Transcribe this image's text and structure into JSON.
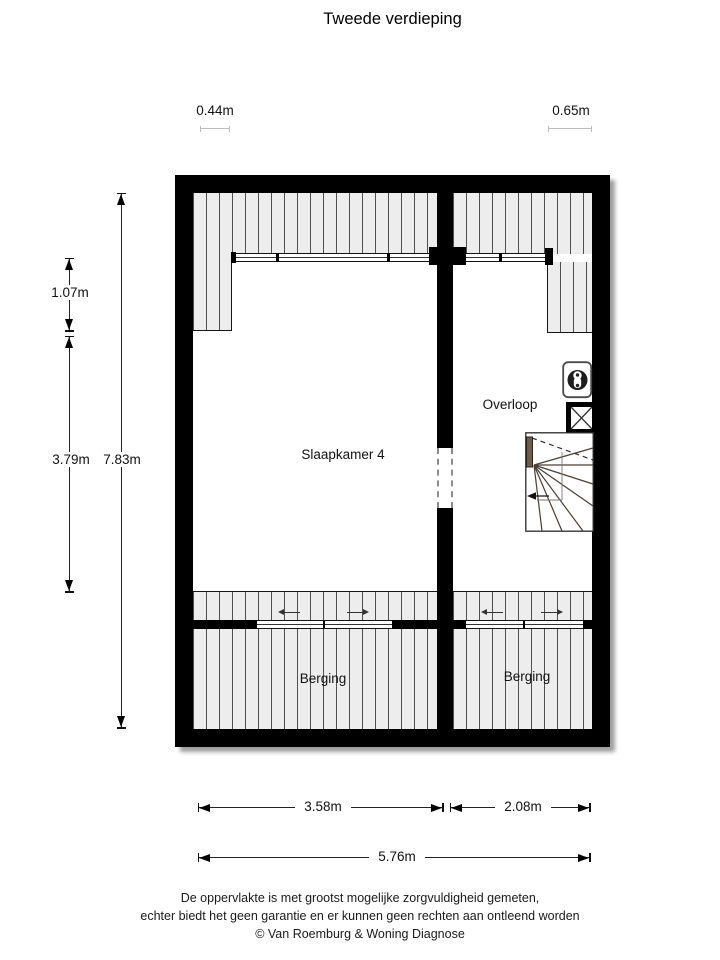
{
  "title": "Tweede verdieping",
  "dimensions": {
    "top_left": "0.44m",
    "top_right": "0.65m",
    "left_upper": "1.07m",
    "left_mid": "3.79m",
    "left_total": "7.83m",
    "bottom_left": "3.58m",
    "bottom_right": "2.08m",
    "bottom_total": "5.76m"
  },
  "rooms": {
    "bedroom": "Slaapkamer 4",
    "landing": "Overloop",
    "storage_left": "Berging",
    "storage_right": "Berging"
  },
  "footer": {
    "lines": [
      "De oppervlakte is met grootst mogelijke zorgvuldigheid gemeten,",
      "echter biedt het geen garantie en er kunnen geen rechten aan ontleend worden",
      "© Van Roemburg & Woning Diagnose"
    ]
  },
  "colors": {
    "wall": "#000000",
    "hatch_bg": "#ededed",
    "hatch_line": "#4f4f4f",
    "stair_wood": "#6f5d49",
    "dimension": "#222222"
  }
}
